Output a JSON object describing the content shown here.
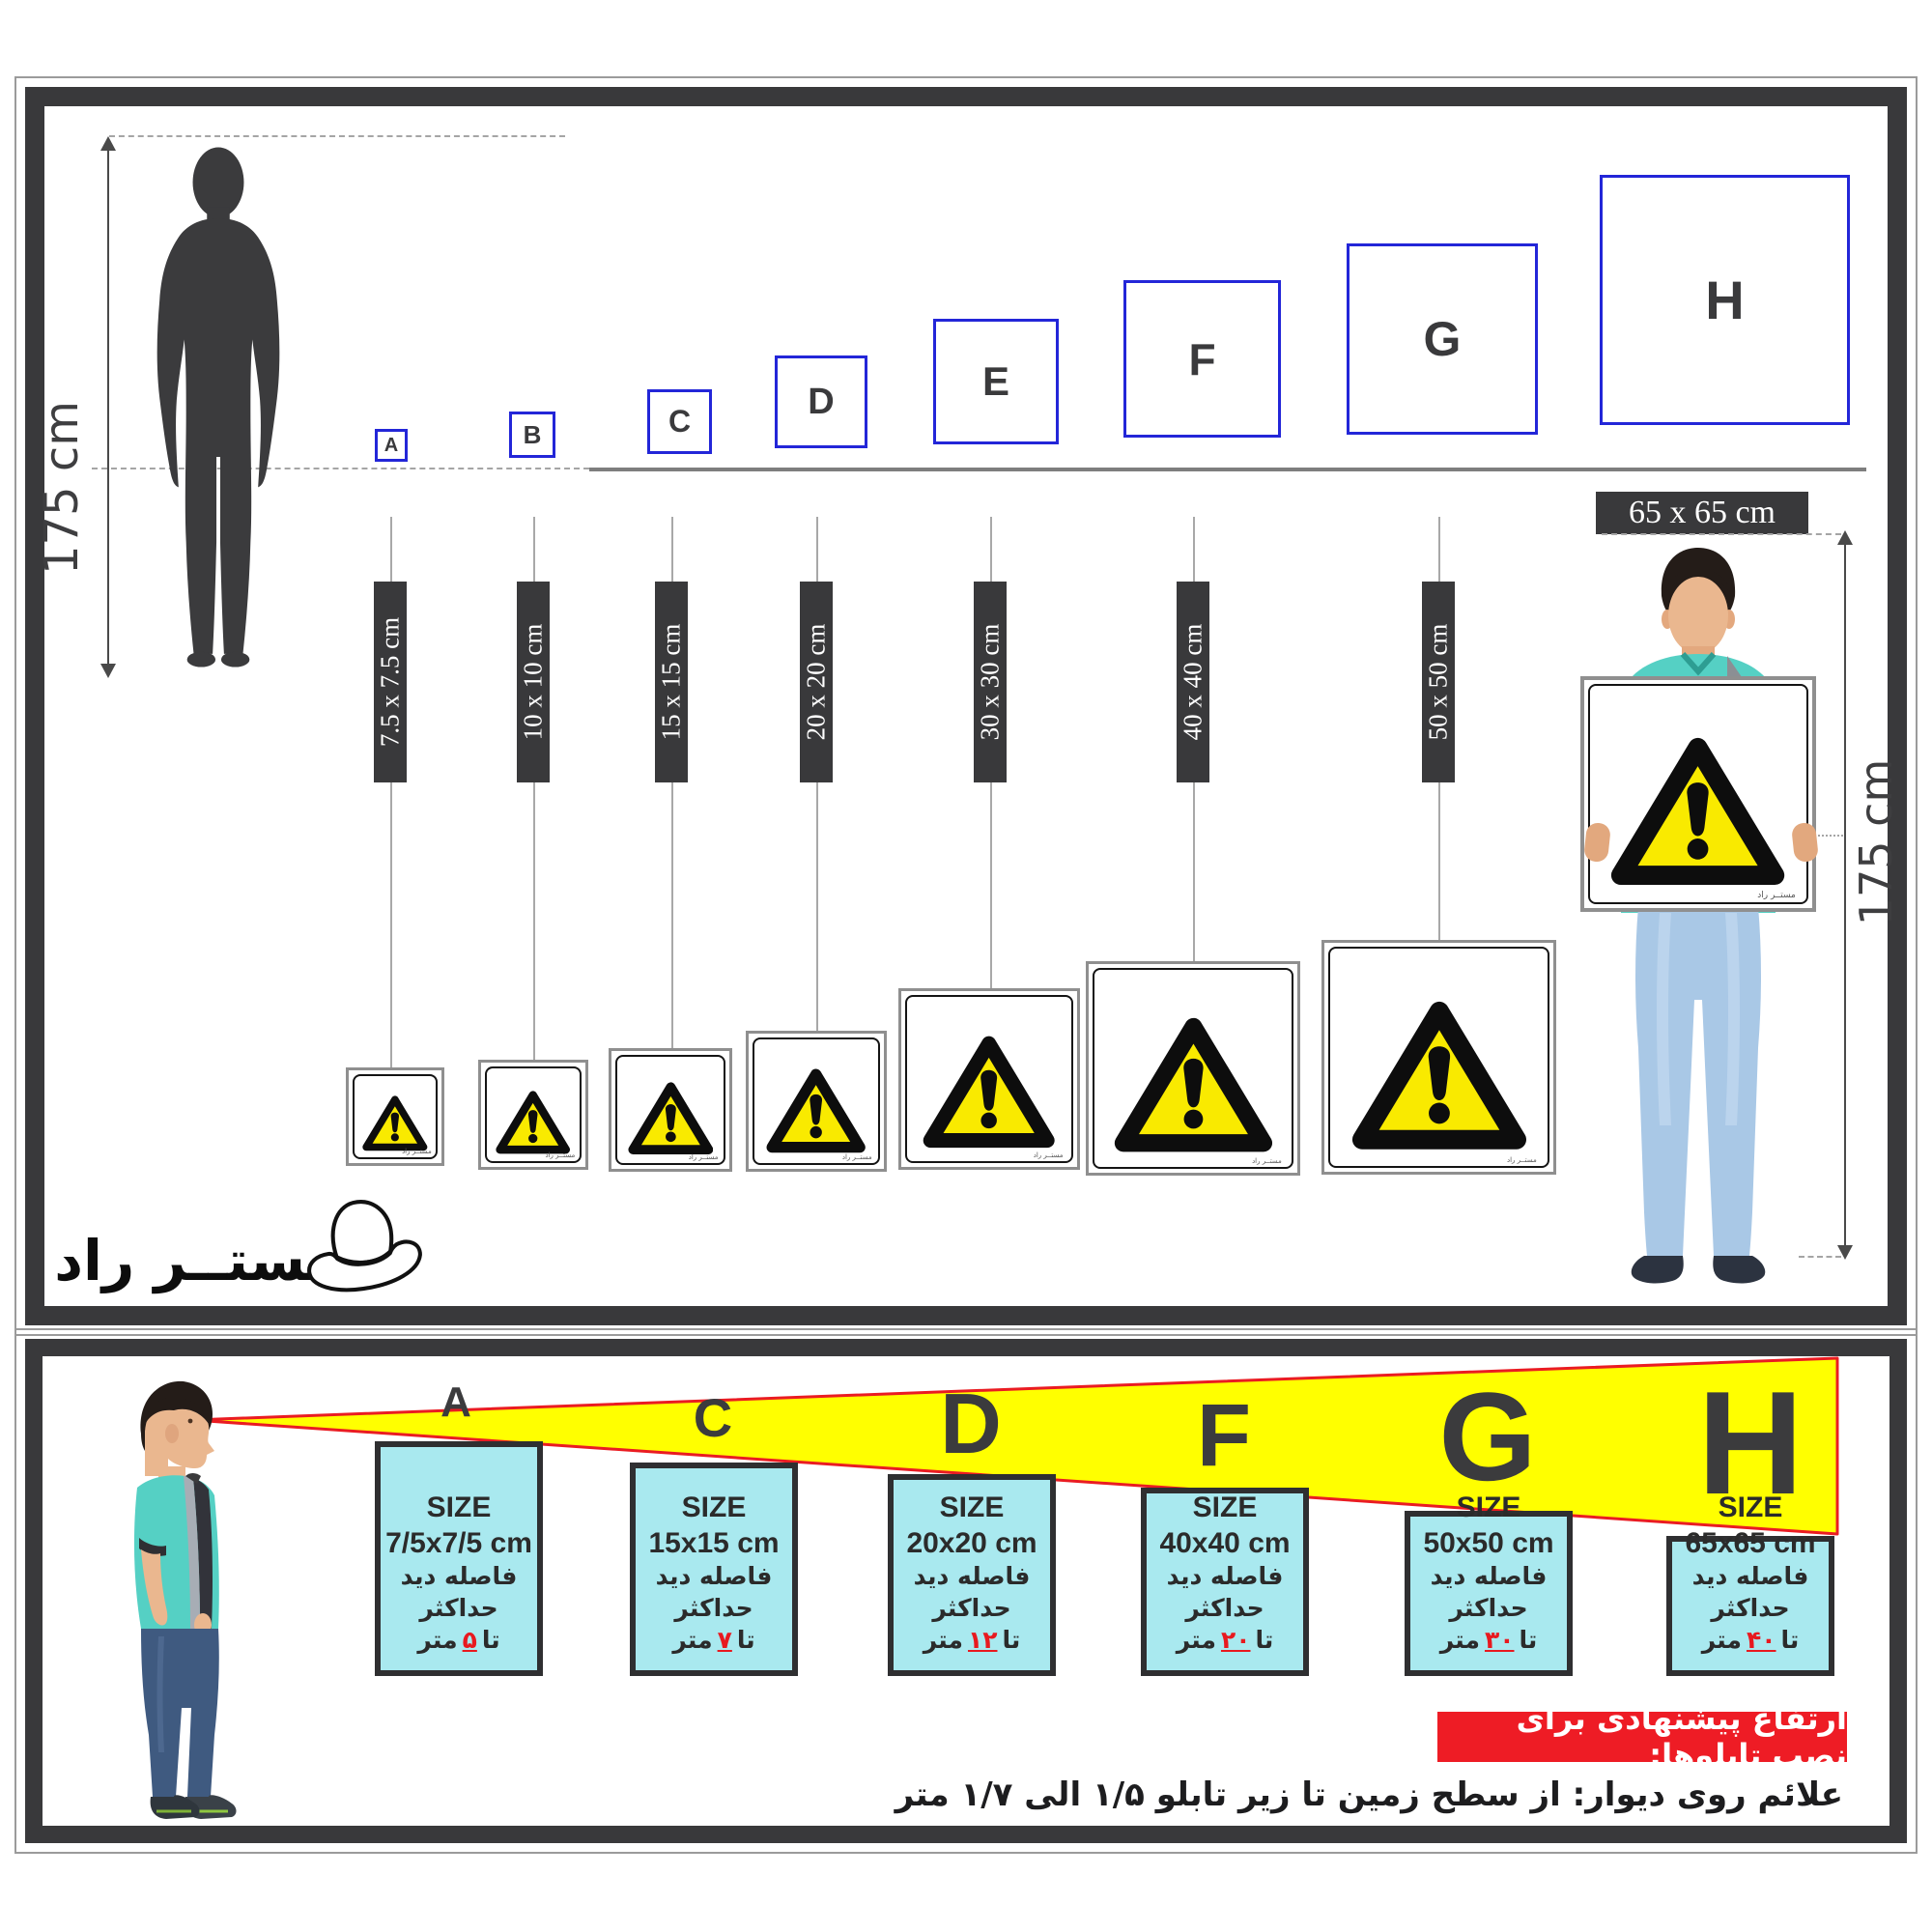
{
  "brand": {
    "logo_text": "مستــر راد"
  },
  "top_section": {
    "person_height": "175 cm",
    "holder_height": "175 cm",
    "held_sign_size": "65 x 65 cm",
    "squares": [
      {
        "letter": "A"
      },
      {
        "letter": "B"
      },
      {
        "letter": "C"
      },
      {
        "letter": "D"
      },
      {
        "letter": "E"
      },
      {
        "letter": "F"
      },
      {
        "letter": "G"
      },
      {
        "letter": "H"
      }
    ],
    "size_banners": [
      "7.5 x 7.5 cm",
      "10 x 10 cm",
      "15 x 15 cm",
      "20 x 20 cm",
      "30 x 30 cm",
      "40 x 40 cm",
      "50 x 50 cm"
    ]
  },
  "bottom_section": {
    "view_letters": [
      "A",
      "C",
      "D",
      "F",
      "G",
      "H"
    ],
    "size_boxes": [
      {
        "letter": "A",
        "size_label": "SIZE",
        "size_value": "7/5x7/5 cm",
        "distance_line": "فاصله دید حداکثر",
        "prefix": "تا",
        "distance": "۵",
        "unit": "متر"
      },
      {
        "letter": "C",
        "size_label": "SIZE",
        "size_value": "15x15 cm",
        "distance_line": "فاصله دید حداکثر",
        "prefix": "تا",
        "distance": "۷",
        "unit": "متر"
      },
      {
        "letter": "D",
        "size_label": "SIZE",
        "size_value": "20x20 cm",
        "distance_line": "فاصله دید حداکثر",
        "prefix": "تا",
        "distance": "۱۲",
        "unit": "متر"
      },
      {
        "letter": "F",
        "size_label": "SIZE",
        "size_value": "40x40 cm",
        "distance_line": "فاصله دید حداکثر",
        "prefix": "تا",
        "distance": "۲۰",
        "unit": "متر"
      },
      {
        "letter": "G",
        "size_label": "SIZE",
        "size_value": "50x50 cm",
        "distance_line": "فاصله دید حداکثر",
        "prefix": "تا",
        "distance": "۳۰",
        "unit": "متر"
      },
      {
        "letter": "H",
        "size_label": "SIZE",
        "size_value": "65x65 cm",
        "distance_line": "فاصله دید حداکثر",
        "prefix": "تا",
        "distance": "۴۰",
        "unit": "متر"
      }
    ],
    "note_title": "ارتفاع پیشنهادی برای نصب تابلوها:",
    "note_text": "علائم روی دیوار: از سطح زمین تا زیر تابلو ۱/۵ الی ۱/۷ متر"
  },
  "colors": {
    "frame_dark": "#39393b",
    "square_blue": "#2326d8",
    "sign_yellow": "#f9ea00",
    "cone_yellow": "#ffff00",
    "accent_red": "#ee1c25",
    "box_cyan": "#a9e9ef"
  }
}
